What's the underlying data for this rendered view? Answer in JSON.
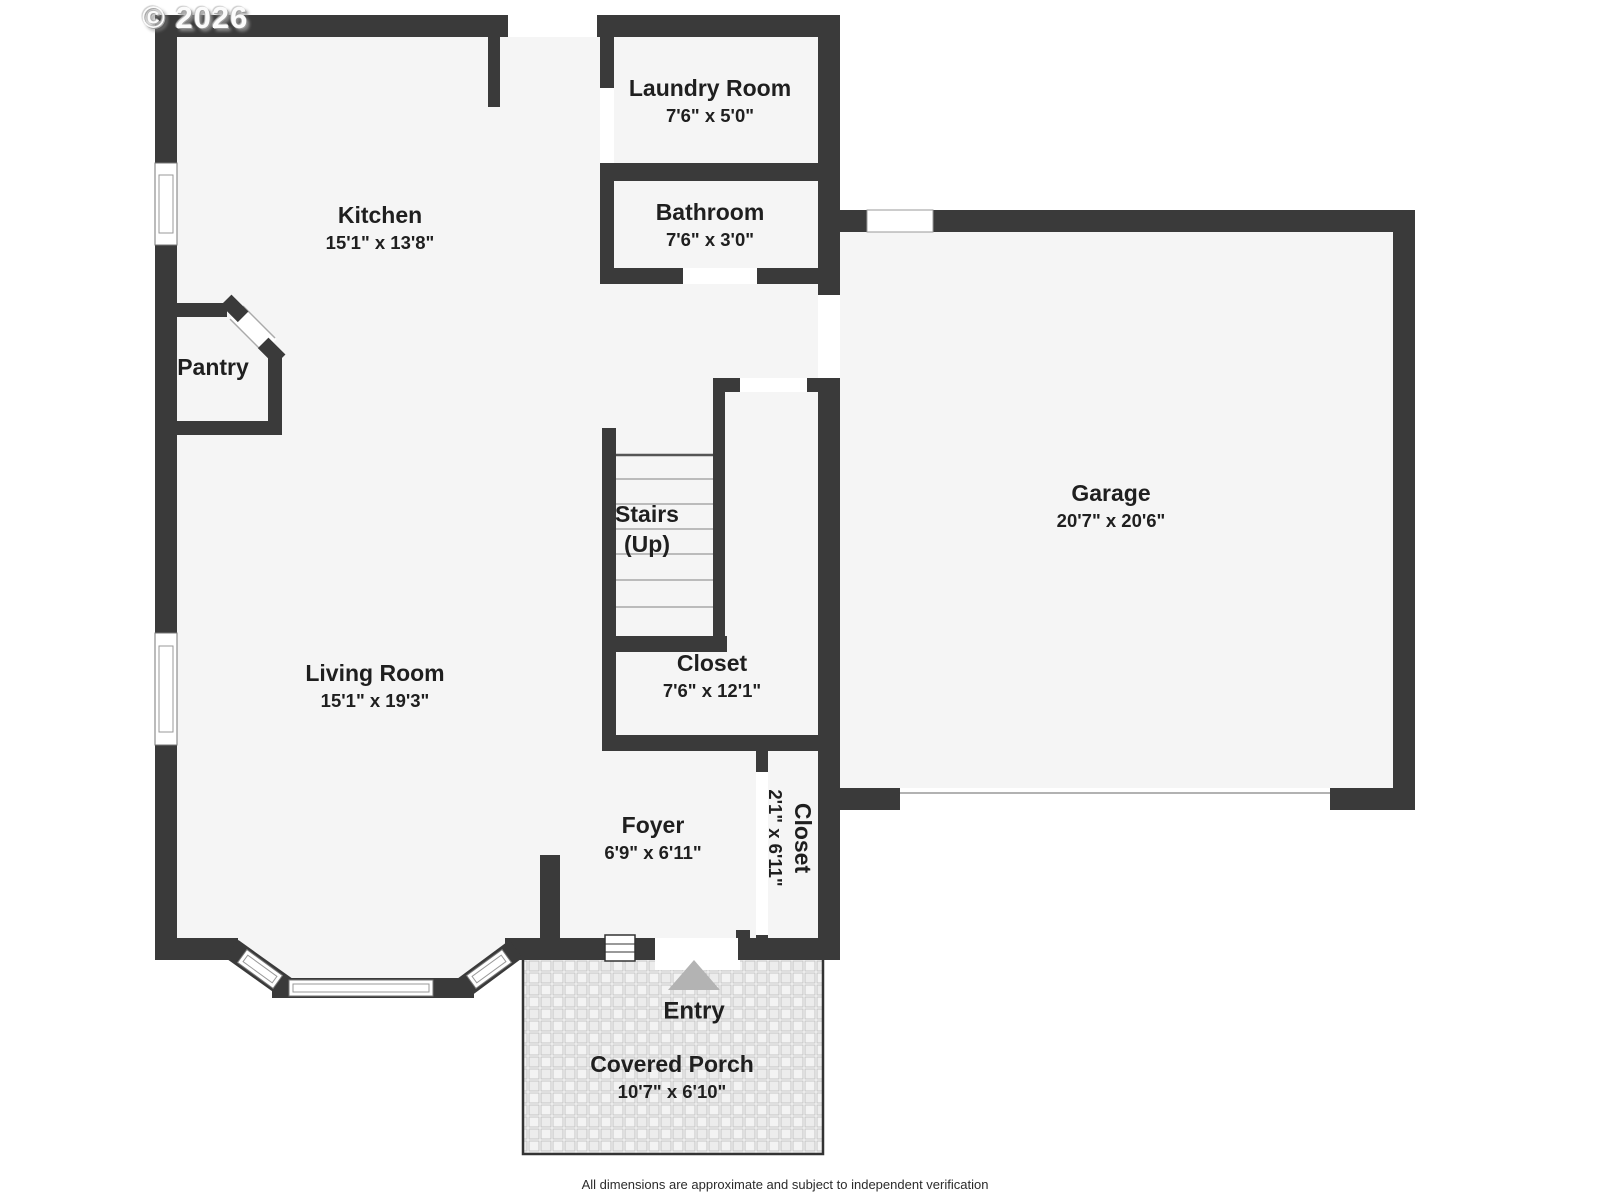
{
  "watermark": "© 2026",
  "footer": "All dimensions are approximate and subject to independent verification",
  "colors": {
    "wall": "#3a3a3a",
    "room_fill": "#f5f5f5",
    "entry_arrow": "#b3b3b3",
    "step_line": "#a8a8a8"
  },
  "rooms": {
    "laundry": {
      "name": "Laundry Room",
      "dims": "7'6\" x 5'0\""
    },
    "bathroom": {
      "name": "Bathroom",
      "dims": "7'6\" x 3'0\""
    },
    "kitchen": {
      "name": "Kitchen",
      "dims": "15'1\" x 13'8\""
    },
    "pantry": {
      "name": "Pantry"
    },
    "garage": {
      "name": "Garage",
      "dims": "20'7\" x 20'6\""
    },
    "stairs": {
      "name": "Stairs",
      "direction": "(Up)"
    },
    "living": {
      "name": "Living Room",
      "dims": "15'1\" x 19'3\""
    },
    "closet": {
      "name": "Closet",
      "dims": "7'6\" x 12'1\""
    },
    "foyer": {
      "name": "Foyer",
      "dims": "6'9\" x 6'11\""
    },
    "entry_closet": {
      "name": "Closet",
      "dims": "2'1\" x 6'11\""
    },
    "entry": {
      "name": "Entry"
    },
    "porch": {
      "name": "Covered Porch",
      "dims": "10'7\" x 6'10\""
    }
  }
}
